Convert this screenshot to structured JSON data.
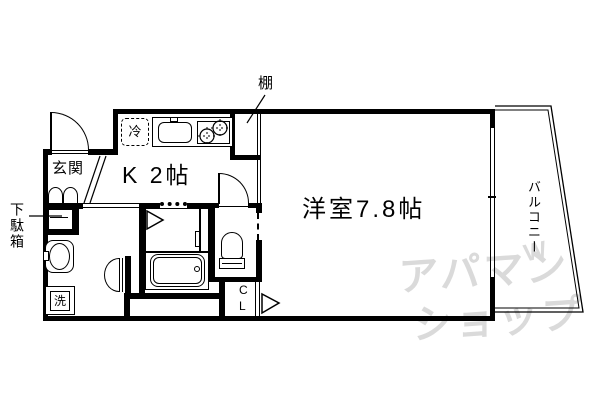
{
  "floorplan": {
    "rooms": {
      "kitchen": {
        "label": "K 2帖"
      },
      "main_room": {
        "label": "洋室7.8帖"
      },
      "entrance": {
        "label": "玄関"
      },
      "balcony": {
        "label": "バルコニー"
      }
    },
    "fixtures": {
      "shelf": "棚",
      "shoe_cabinet": "下駄箱",
      "refrigerator": "冷",
      "washing_machine": "洗",
      "closet_line1": "C",
      "closet_line2": "L"
    },
    "watermark": {
      "line1": "アパマン",
      "line2": "ショップ",
      "mark": "W"
    },
    "colors": {
      "wall": "#000000",
      "background": "#ffffff",
      "watermark": "#dadada"
    }
  }
}
